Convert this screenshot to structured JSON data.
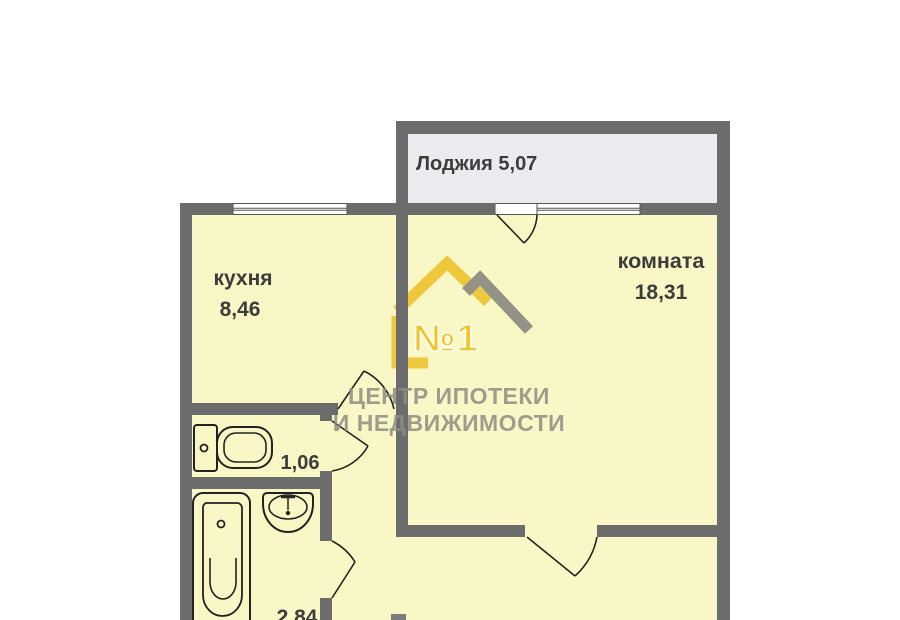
{
  "plan": {
    "rooms": {
      "loggia": {
        "label": "Лоджия 5,07"
      },
      "kitchen": {
        "name": "кухня",
        "area": "8,46"
      },
      "living_room": {
        "name": "комната",
        "area": "18,31"
      },
      "wc": {
        "area": "1,06"
      },
      "bathroom": {
        "area": "2,84"
      }
    },
    "colors": {
      "wall": "#6c6c6c",
      "room_fill": "#faf7c6",
      "loggia_fill": "#e9ebee",
      "outline": "#222222",
      "label_text": "#3c3c3c",
      "logo_yellow": "#edc32f",
      "logo_gray": "#8b8b80",
      "watermark_text": "#8e8e84"
    }
  },
  "watermark": {
    "badge": "№1",
    "line1": "ЦЕНТР ИПОТЕКИ",
    "line2": "И НЕДВИЖИМОСТИ"
  }
}
